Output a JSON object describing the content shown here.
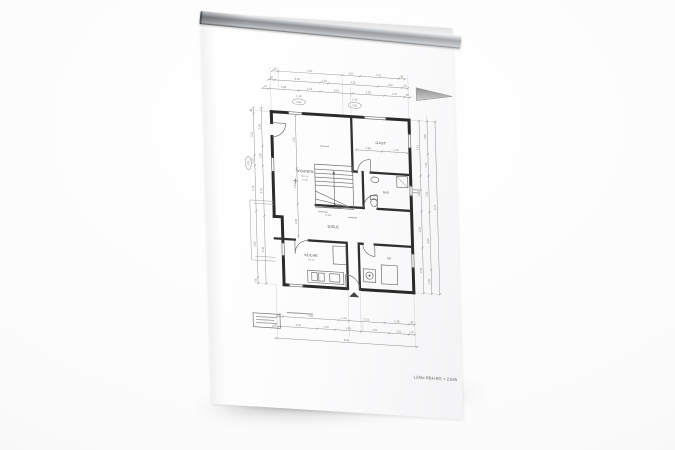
{
  "colors": {
    "background": "#f7f7f7",
    "paper": "#fcfcfd",
    "rail_metal": "#8e9296",
    "wall_ink": "#1e1e1e",
    "dim_ink": "#8b8b8b",
    "wedge_gray": "#9c9c9c"
  },
  "plan": {
    "rooms": {
      "living": "WOHNEN",
      "living_sub1": "38,2 m²",
      "living_sub2": "±0,00",
      "guest": "GAST",
      "hall": "DIELE",
      "bath": "BAD",
      "kitchen": "KÜCHE",
      "kitchen_sub": "9,8 m²",
      "storage": "AR"
    },
    "stair_note": "16 Stg",
    "note": "Lichte RBH EG + 2,625",
    "dims": {
      "top1": [
        "36",
        "5,01",
        "1,51",
        "2,51",
        "36"
      ],
      "top2": [
        "36",
        "3,26",
        "1,01",
        "4,26",
        "1,01",
        "24"
      ],
      "top3": [
        "12",
        "2,88",
        "1,13",
        "3,01",
        "2,63",
        "1,76",
        "36"
      ],
      "lintel_left_top": "1,13",
      "lintel_left_oval": "2,01",
      "lintel_right_top": "1,13",
      "lintel_right_oval": "2,01",
      "bottom1": [
        "24",
        "5,01",
        "1,13",
        "2,51",
        "1,38",
        "36"
      ],
      "bottom2": [
        "17",
        "3,26",
        "1,26",
        "1,38",
        "2,51",
        "1,51",
        "24"
      ],
      "bottom_total": "9,49",
      "left1": [
        "36",
        "2,51",
        "1,01",
        "2,76",
        "3,96",
        "36"
      ],
      "left2": [
        "2,26",
        "1,26",
        "3,01",
        "4,08"
      ],
      "left_oval": "2,01",
      "right1": [
        "3,13",
        "2,01",
        "2,01",
        "2,63"
      ],
      "right2": [
        "1,88",
        "1,26",
        "2,01",
        "3,26",
        "1,38"
      ],
      "right_total": "9,74",
      "interior_v": [
        "2,26",
        "1,51",
        "1,38"
      ],
      "interior_h": [
        "2,38",
        "1,13"
      ]
    }
  }
}
